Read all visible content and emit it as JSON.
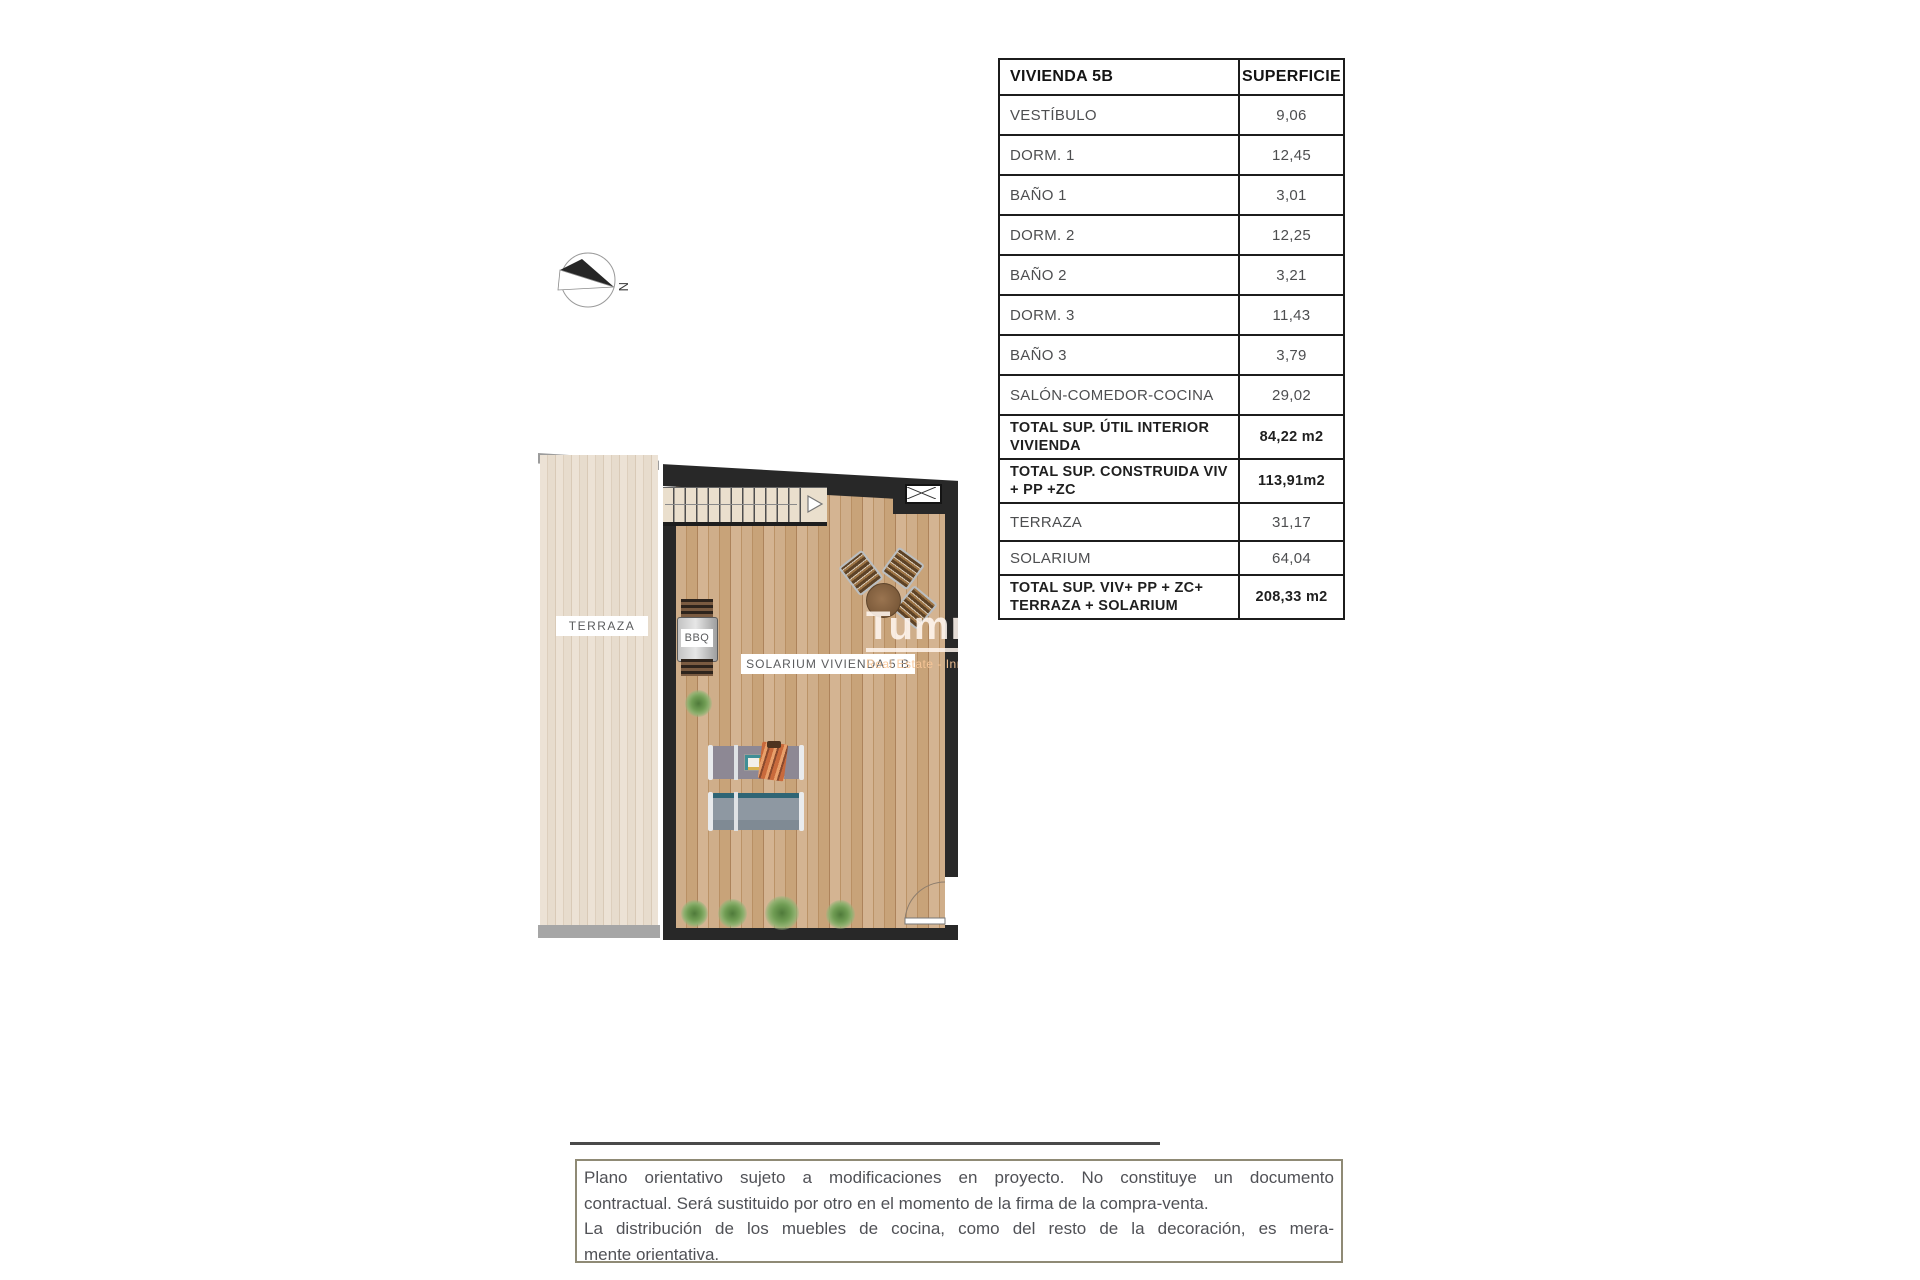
{
  "surface_table": {
    "header": {
      "name": "VIVIENDA 5B",
      "value": "SUPERFICIE"
    },
    "rows": [
      {
        "label": "VESTÍBULO",
        "value": "9,06"
      },
      {
        "label": "DORM. 1",
        "value": "12,45"
      },
      {
        "label": "BAÑO 1",
        "value": "3,01"
      },
      {
        "label": "DORM. 2",
        "value": "12,25"
      },
      {
        "label": "BAÑO 2",
        "value": "3,21"
      },
      {
        "label": "DORM. 3",
        "value": "11,43"
      },
      {
        "label": "BAÑO 3",
        "value": "3,79"
      },
      {
        "label": "SALÓN-COMEDOR-COCINA",
        "value": "29,02"
      },
      {
        "label": "TOTAL SUP. ÚTIL INTERIOR VIVIENDA",
        "value": "84,22 m2"
      },
      {
        "label": "TOTAL SUP. CONSTRUIDA VIV + PP +ZC",
        "value": "113,91m2"
      },
      {
        "label": "TERRAZA",
        "value": "31,17"
      },
      {
        "label": "SOLARIUM",
        "value": "64,04"
      },
      {
        "label": "TOTAL SUP. VIV+ PP + ZC+ TERRAZA + SOLARIUM",
        "value": "208,33 m2"
      }
    ]
  },
  "plan": {
    "labels": {
      "terraza": "TERRAZA",
      "solarium": "SOLARIUM VIVIENDA 5 B",
      "bbq": "BBQ"
    },
    "compass_label": "N",
    "watermark": {
      "title": "Tumme",
      "subtitle": "Real Estate - Inmobiliar"
    }
  },
  "disclaimer": {
    "lines": [
      "Plano orientativo sujeto a modificaciones en proyecto. No constituye un documento",
      "contractual. Será sustituido por otro en el momento de la firma de la compra-venta.",
      "La distribución de los muebles de cocina, como del resto de la decoración, es mera-",
      "mente orientativa."
    ]
  },
  "colors": {
    "wall": "#282828",
    "solarium_floor": "#c8a379",
    "terraza_floor": "#e9dfd1",
    "table_border": "#1c1c1c",
    "text_gray": "#4d4e50",
    "disclaimer_border": "#8f8a75",
    "plant_green": "#6f9c53"
  }
}
